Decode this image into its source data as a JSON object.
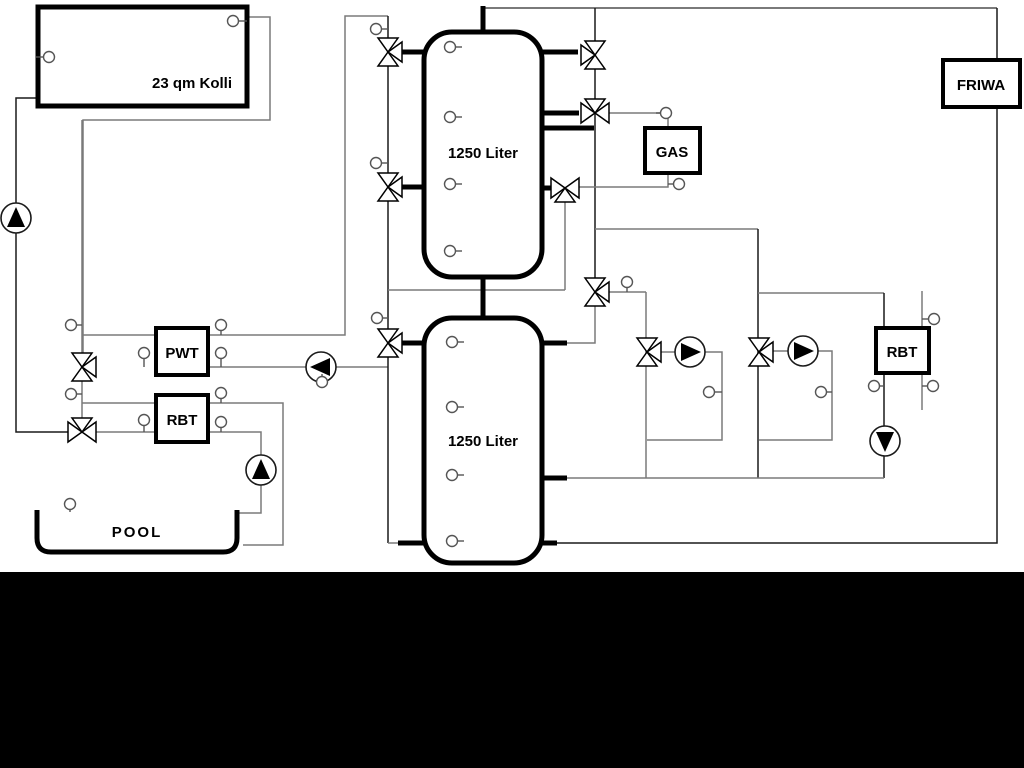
{
  "diagram_title": "Hydraulic heating scheme with solar collector, buffer tanks, gas boiler, pool and FRIWA",
  "colors": {
    "background": "#ffffff",
    "band": "#000000",
    "pipe_gray": "#7a7a7a",
    "pipe_dark": "#1a1a1a",
    "thick_black": "#000000"
  },
  "band": {
    "x": 0,
    "y": 572,
    "w": 1024,
    "h": 196
  },
  "boxes": [
    {
      "name": "solar-collector",
      "label": "23 qm Kolli",
      "x": 38,
      "y": 7,
      "w": 209,
      "h": 99,
      "lw": 5,
      "lx": 192,
      "ly": 88
    },
    {
      "name": "pwt-heat-exchanger",
      "label": "PWT",
      "x": 156,
      "y": 328,
      "w": 52,
      "h": 47,
      "lw": 4,
      "lx": 182,
      "ly": 358
    },
    {
      "name": "rbt-left",
      "label": "RBT",
      "x": 156,
      "y": 395,
      "w": 52,
      "h": 47,
      "lw": 4,
      "lx": 182,
      "ly": 425
    },
    {
      "name": "gas-boiler",
      "label": "GAS",
      "x": 645,
      "y": 128,
      "w": 55,
      "h": 45,
      "lw": 4,
      "lx": 672,
      "ly": 157
    },
    {
      "name": "friwa-station",
      "label": "FRIWA",
      "x": 943,
      "y": 60,
      "w": 77,
      "h": 47,
      "lw": 4,
      "lx": 981,
      "ly": 90
    },
    {
      "name": "rbt-right",
      "label": "RBT",
      "x": 876,
      "y": 328,
      "w": 53,
      "h": 45,
      "lw": 4,
      "lx": 902,
      "ly": 357
    }
  ],
  "tanks": [
    {
      "name": "buffer-tank-upper",
      "label": "1250 Liter",
      "x": 424,
      "y": 32,
      "w": 118,
      "h": 245,
      "lx": 483,
      "ly": 158
    },
    {
      "name": "buffer-tank-lower",
      "label": "1250 Liter",
      "x": 424,
      "y": 318,
      "w": 118,
      "h": 245,
      "lx": 483,
      "ly": 446
    }
  ],
  "pool": {
    "name": "pool",
    "label": "POOL",
    "x1": 37,
    "x2": 237,
    "top": 510,
    "bottom": 552,
    "r": 14,
    "lx": 137,
    "ly": 537
  },
  "pipes": [
    {
      "c": "gray",
      "w": 1.5,
      "pts": [
        [
          247,
          17
        ],
        [
          270,
          17
        ],
        [
          270,
          120
        ],
        [
          83,
          120
        ],
        [
          83,
          355
        ]
      ]
    },
    {
      "c": "dark",
      "w": 1.5,
      "pts": [
        [
          38,
          98
        ],
        [
          16,
          98
        ],
        [
          16,
          432
        ],
        [
          68,
          432
        ]
      ]
    },
    {
      "c": "gray",
      "w": 1.5,
      "pts": [
        [
          82,
          120
        ],
        [
          82,
          432
        ]
      ]
    },
    {
      "c": "gray",
      "w": 1.5,
      "pts": [
        [
          82,
          335
        ],
        [
          156,
          335
        ]
      ]
    },
    {
      "c": "gray",
      "w": 1.5,
      "pts": [
        [
          82,
          403
        ],
        [
          156,
          403
        ]
      ]
    },
    {
      "c": "gray",
      "w": 1.5,
      "pts": [
        [
          68,
          432
        ],
        [
          156,
          432
        ]
      ]
    },
    {
      "c": "gray",
      "w": 1.5,
      "pts": [
        [
          208,
          335
        ],
        [
          345,
          335
        ],
        [
          345,
          16
        ],
        [
          388,
          16
        ]
      ]
    },
    {
      "c": "gray",
      "w": 1.5,
      "pts": [
        [
          208,
          367
        ],
        [
          388,
          367
        ]
      ]
    },
    {
      "c": "gray",
      "w": 1.5,
      "pts": [
        [
          208,
          403
        ],
        [
          283,
          403
        ],
        [
          283,
          545
        ],
        [
          243,
          545
        ]
      ]
    },
    {
      "c": "gray",
      "w": 1.5,
      "pts": [
        [
          208,
          432
        ],
        [
          261,
          432
        ],
        [
          261,
          513
        ],
        [
          237,
          513
        ]
      ]
    },
    {
      "c": "dark",
      "w": 1.5,
      "pts": [
        [
          388,
          16
        ],
        [
          388,
          543
        ]
      ]
    },
    {
      "c": "gray",
      "w": 1.5,
      "pts": [
        [
          388,
          290
        ],
        [
          565,
          290
        ]
      ]
    },
    {
      "c": "gray",
      "w": 1.5,
      "pts": [
        [
          565,
          188
        ],
        [
          565,
          290
        ]
      ]
    },
    {
      "c": "gray",
      "w": 2,
      "pts": [
        [
          483,
          8
        ],
        [
          997,
          8
        ]
      ]
    },
    {
      "c": "dark",
      "w": 1.5,
      "pts": [
        [
          997,
          8
        ],
        [
          997,
          543
        ],
        [
          556,
          543
        ]
      ]
    },
    {
      "c": "dark",
      "w": 1.5,
      "pts": [
        [
          595,
          8
        ],
        [
          595,
          305
        ]
      ]
    },
    {
      "c": "gray",
      "w": 1.5,
      "pts": [
        [
          595,
          113
        ],
        [
          660,
          113
        ]
      ]
    },
    {
      "c": "gray",
      "w": 1.5,
      "pts": [
        [
          668,
          118
        ],
        [
          668,
          128
        ]
      ]
    },
    {
      "c": "gray",
      "w": 1.5,
      "pts": [
        [
          668,
          173
        ],
        [
          668,
          187
        ],
        [
          578,
          187
        ]
      ]
    },
    {
      "c": "gray",
      "w": 1.5,
      "pts": [
        [
          595,
          229
        ],
        [
          758,
          229
        ]
      ]
    },
    {
      "c": "gray",
      "w": 1.5,
      "pts": [
        [
          609,
          292
        ],
        [
          646,
          292
        ]
      ]
    },
    {
      "c": "gray",
      "w": 1.5,
      "pts": [
        [
          646,
          292
        ],
        [
          646,
          478
        ]
      ]
    },
    {
      "c": "dark",
      "w": 1.5,
      "pts": [
        [
          758,
          229
        ],
        [
          758,
          478
        ]
      ]
    },
    {
      "c": "gray",
      "w": 1.5,
      "pts": [
        [
          758,
          293
        ],
        [
          884,
          293
        ]
      ]
    },
    {
      "c": "dark",
      "w": 1.5,
      "pts": [
        [
          884,
          293
        ],
        [
          884,
          478
        ]
      ]
    },
    {
      "c": "gray",
      "w": 1.5,
      "pts": [
        [
          595,
          305
        ],
        [
          595,
          343
        ],
        [
          566,
          343
        ]
      ]
    },
    {
      "c": "gray",
      "w": 1.5,
      "pts": [
        [
          661,
          352
        ],
        [
          722,
          352
        ],
        [
          722,
          440
        ],
        [
          647,
          440
        ]
      ]
    },
    {
      "c": "gray",
      "w": 1.5,
      "pts": [
        [
          773,
          351
        ],
        [
          832,
          351
        ],
        [
          832,
          440
        ],
        [
          759,
          440
        ]
      ]
    },
    {
      "c": "gray",
      "w": 1.5,
      "pts": [
        [
          567,
          478
        ],
        [
          884,
          478
        ]
      ]
    },
    {
      "c": "gray",
      "w": 1.5,
      "pts": [
        [
          922,
          291
        ],
        [
          922,
          410
        ]
      ]
    },
    {
      "c": "gray",
      "w": 1.5,
      "pts": [
        [
          388,
          543
        ],
        [
          424,
          543
        ]
      ]
    }
  ],
  "thick_stubs": [
    [
      400,
      52,
      425,
      52
    ],
    [
      400,
      187,
      425,
      187
    ],
    [
      400,
      343,
      425,
      343
    ],
    [
      541,
      52,
      578,
      52
    ],
    [
      541,
      113,
      579,
      113
    ],
    [
      541,
      128,
      594,
      128
    ],
    [
      541,
      188,
      553,
      188
    ],
    [
      541,
      343,
      567,
      343
    ],
    [
      541,
      478,
      567,
      478
    ],
    [
      483,
      6,
      483,
      33
    ],
    [
      483,
      276,
      483,
      320
    ],
    [
      398,
      543,
      425,
      543
    ],
    [
      541,
      543,
      557,
      543
    ]
  ],
  "valves": [
    {
      "name": "solar-pwt-valve",
      "x": 82,
      "y": 367,
      "type": "vr"
    },
    {
      "name": "pool-rbt-valve",
      "x": 82,
      "y": 432,
      "type": "ht"
    },
    {
      "name": "tank1-top-charge-valve",
      "x": 388,
      "y": 52,
      "type": "vr"
    },
    {
      "name": "tank1-mid-charge-valve",
      "x": 388,
      "y": 187,
      "type": "vr"
    },
    {
      "name": "tank2-top-charge-valve",
      "x": 388,
      "y": 343,
      "type": "vr"
    },
    {
      "name": "tank1-top-out-valve",
      "x": 595,
      "y": 55,
      "type": "vl"
    },
    {
      "name": "gas-supply-valve",
      "x": 595,
      "y": 113,
      "type": "ht"
    },
    {
      "name": "gas-return-valve",
      "x": 565,
      "y": 188,
      "type": "hb"
    },
    {
      "name": "distribution-valve",
      "x": 595,
      "y": 292,
      "type": "vr"
    },
    {
      "name": "heating-circuit1-mixer",
      "x": 647,
      "y": 352,
      "type": "vr"
    },
    {
      "name": "heating-circuit2-mixer",
      "x": 759,
      "y": 352,
      "type": "vr"
    }
  ],
  "pumps": [
    {
      "name": "solar-pump",
      "x": 16,
      "y": 218,
      "dir": "up"
    },
    {
      "name": "pool-pump",
      "x": 261,
      "y": 470,
      "dir": "up"
    },
    {
      "name": "pwt-charge-pump",
      "x": 321,
      "y": 367,
      "dir": "left"
    },
    {
      "name": "circuit1-pump",
      "x": 690,
      "y": 352,
      "dir": "right"
    },
    {
      "name": "circuit2-pump",
      "x": 803,
      "y": 351,
      "dir": "right"
    },
    {
      "name": "rbt-right-pump",
      "x": 885,
      "y": 441,
      "dir": "down"
    }
  ],
  "sensors": [
    {
      "x": 49,
      "y": 57,
      "sx": 36,
      "sy": 57
    },
    {
      "x": 233,
      "y": 21,
      "sx": 247,
      "sy": 21
    },
    {
      "x": 71,
      "y": 325,
      "sx": 82,
      "sy": 325
    },
    {
      "x": 71,
      "y": 394,
      "sx": 82,
      "sy": 394
    },
    {
      "x": 144,
      "y": 353,
      "sx": 144,
      "sy": 367
    },
    {
      "x": 144,
      "y": 420,
      "sx": 144,
      "sy": 432
    },
    {
      "x": 221,
      "y": 325,
      "sx": 221,
      "sy": 335
    },
    {
      "x": 221,
      "y": 353,
      "sx": 221,
      "sy": 367
    },
    {
      "x": 221,
      "y": 393,
      "sx": 221,
      "sy": 403
    },
    {
      "x": 221,
      "y": 422,
      "sx": 221,
      "sy": 432
    },
    {
      "x": 70,
      "y": 504,
      "sx": 70,
      "sy": 512
    },
    {
      "x": 322,
      "y": 382,
      "sx": 322,
      "sy": 374
    },
    {
      "x": 376,
      "y": 29,
      "sx": 388,
      "sy": 29
    },
    {
      "x": 376,
      "y": 163,
      "sx": 388,
      "sy": 163
    },
    {
      "x": 377,
      "y": 318,
      "sx": 388,
      "sy": 318
    },
    {
      "x": 666,
      "y": 113,
      "sx": 656,
      "sy": 113
    },
    {
      "x": 679,
      "y": 184,
      "sx": 668,
      "sy": 184
    },
    {
      "x": 627,
      "y": 282,
      "sx": 627,
      "sy": 292
    },
    {
      "x": 709,
      "y": 392,
      "sx": 722,
      "sy": 392
    },
    {
      "x": 821,
      "y": 392,
      "sx": 832,
      "sy": 392
    },
    {
      "x": 874,
      "y": 386,
      "sx": 884,
      "sy": 386
    },
    {
      "x": 934,
      "y": 319,
      "sx": 922,
      "sy": 319
    },
    {
      "x": 933,
      "y": 386,
      "sx": 922,
      "sy": 386
    },
    {
      "x": 450,
      "y": 47,
      "sx": 462,
      "sy": 47
    },
    {
      "x": 450,
      "y": 117,
      "sx": 462,
      "sy": 117
    },
    {
      "x": 450,
      "y": 184,
      "sx": 462,
      "sy": 184
    },
    {
      "x": 450,
      "y": 251,
      "sx": 462,
      "sy": 251
    },
    {
      "x": 452,
      "y": 342,
      "sx": 464,
      "sy": 342
    },
    {
      "x": 452,
      "y": 407,
      "sx": 464,
      "sy": 407
    },
    {
      "x": 452,
      "y": 475,
      "sx": 464,
      "sy": 475
    },
    {
      "x": 452,
      "y": 541,
      "sx": 464,
      "sy": 541
    }
  ]
}
